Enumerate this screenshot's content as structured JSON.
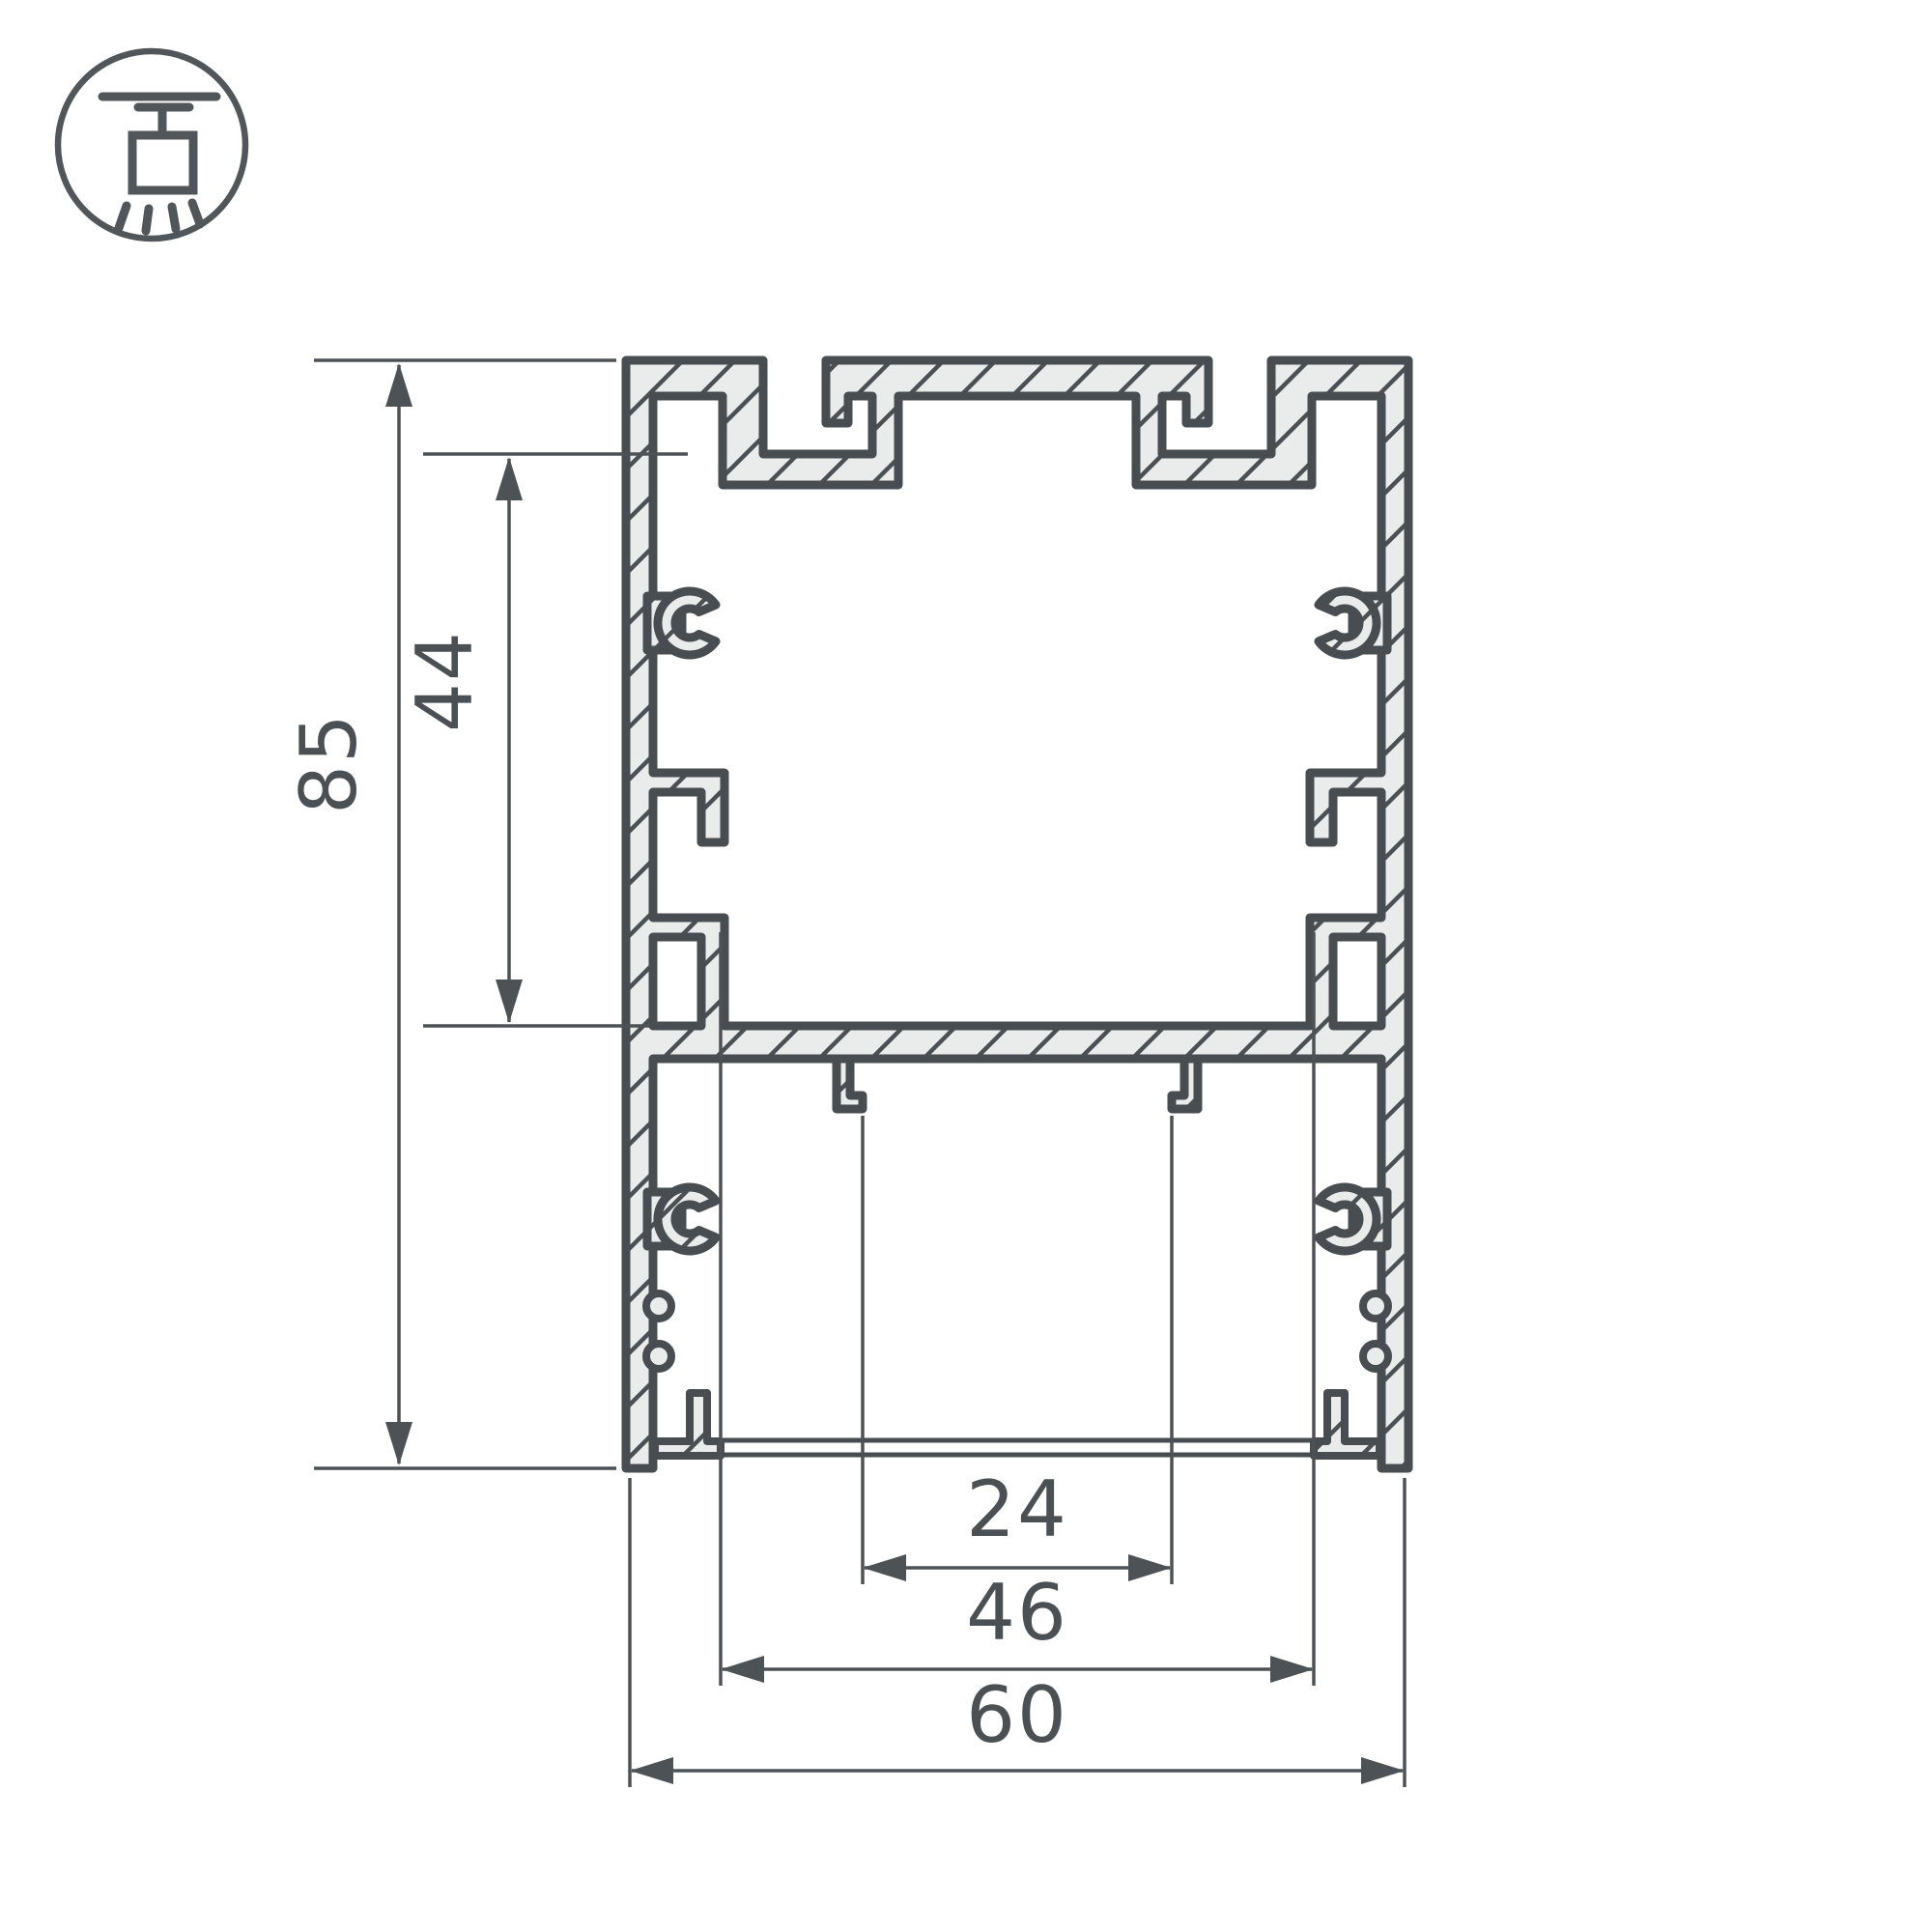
{
  "drawing": {
    "type": "aluminium-profile-cross-section",
    "icon": {
      "name": "pendant-ceiling-light-icon"
    },
    "dimensions": {
      "overall_height": {
        "value": "85",
        "orientation": "vertical"
      },
      "inner_height": {
        "value": "44",
        "orientation": "vertical"
      },
      "led_slot_width": {
        "value": "24",
        "orientation": "horizontal"
      },
      "inner_width": {
        "value": "46",
        "orientation": "horizontal"
      },
      "overall_width": {
        "value": "60",
        "orientation": "horizontal"
      }
    },
    "colors": {
      "outline": "#474d51",
      "dimension": "#4d5256",
      "hatch_fill": "#eaeceb",
      "background": "#ffffff"
    }
  }
}
